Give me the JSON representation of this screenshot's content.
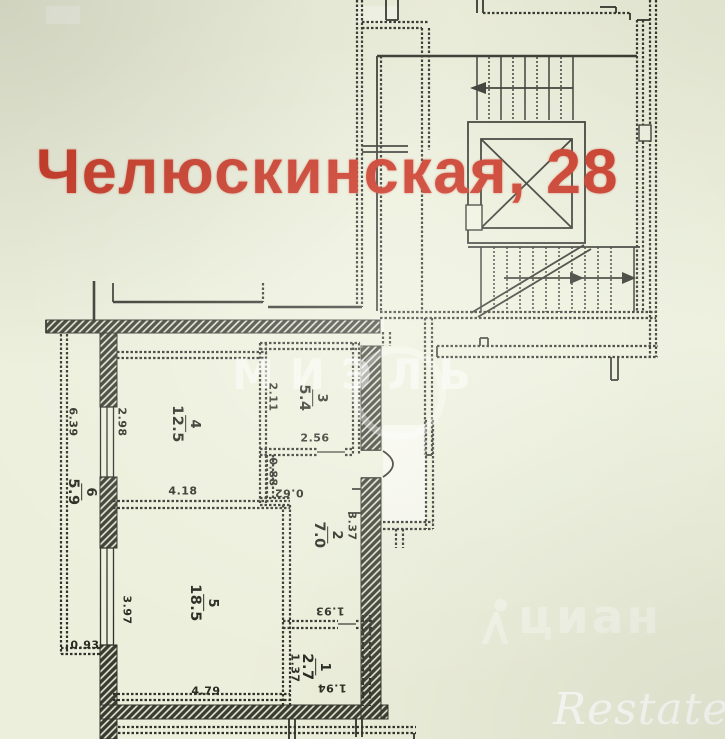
{
  "title": {
    "text": "Челюскинская, 28",
    "color": "#c92f1d"
  },
  "plan": {
    "rooms": [
      {
        "number": "1",
        "area": "2.7"
      },
      {
        "number": "2",
        "area": "7.0"
      },
      {
        "number": "3",
        "area": "5.4"
      },
      {
        "number": "4",
        "area": "12.5"
      },
      {
        "number": "5",
        "area": "18.5"
      },
      {
        "number": "6",
        "area": "5.9"
      }
    ],
    "dimensions": [
      "6.39",
      "0.93",
      "2.98",
      "4.18",
      "2.11",
      "2.56",
      "0.88",
      "0.62",
      "3.37",
      "1.93",
      "3.97",
      "4.79",
      "1.37",
      "1.94"
    ]
  },
  "watermarks": {
    "agency": "МИЭЛЬ",
    "portal": "циан",
    "brand": "Restate"
  },
  "colors": {
    "background": "#ecefdb",
    "ink": "#30312a",
    "title_red": "#c92f1d",
    "watermark": "#ffffff"
  }
}
